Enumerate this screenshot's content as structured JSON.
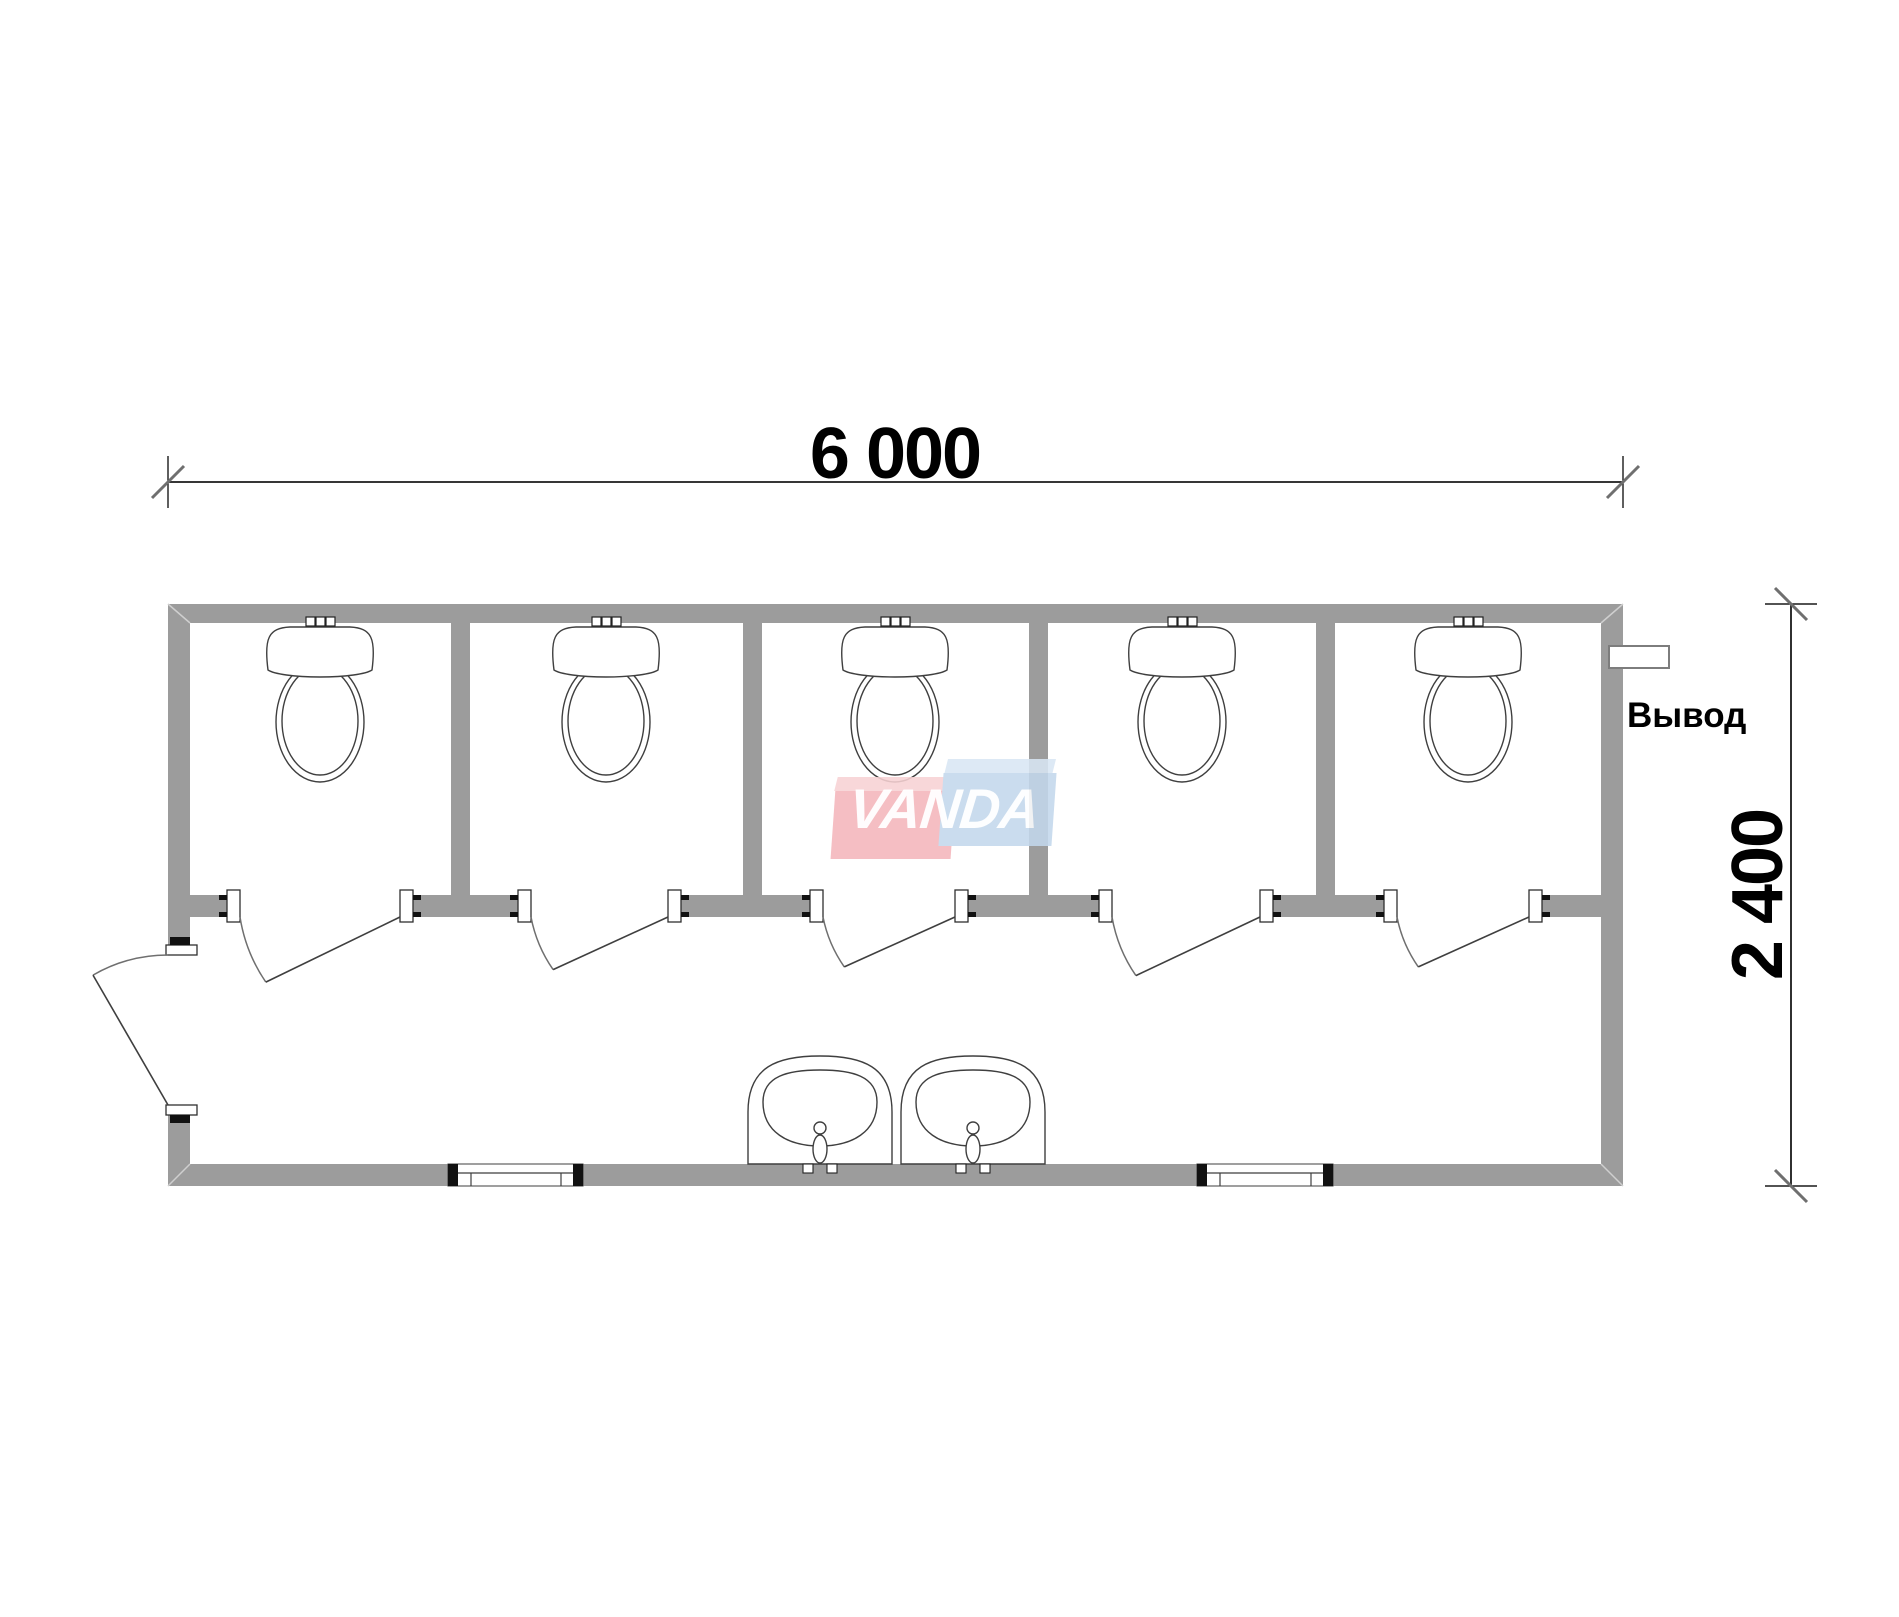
{
  "title": "Sanitary cabin floor plan 6000x2400 with five toilets and two sinks",
  "labels": {
    "width_dimension": "6 000",
    "height_dimension": "2 400",
    "outlet": "Вывод",
    "watermark": "VANDA"
  },
  "colors": {
    "background": "#ffffff",
    "wall_fill": "#9c9c9c",
    "wall_miter": "#cfcfcf",
    "outline": "#3a3a3a",
    "fixture_line": "#3f3f3f",
    "dim_line": "#1a1a1a",
    "tick": "#6f6f6f",
    "jamb_fill": "#ffffff",
    "jamb_stroke": "#2f2f2f",
    "mark_black": "#111111",
    "watermark_pink": "#f4b6bb",
    "watermark_pink_light": "#f8d2d4",
    "watermark_blue": "#c3d8ec",
    "watermark_blue_light": "#d9e7f4",
    "watermark_text": "#ffffff"
  },
  "plan": {
    "building": {
      "left": 168,
      "top": 604,
      "right": 1623,
      "bottom": 1186,
      "top_wall_h": 19,
      "side_wall_w": 22,
      "bottom_wall_h": 22
    },
    "left_door": {
      "opening_top": 955,
      "opening_bottom": 1105,
      "jamb_h": 10,
      "hinge": [
        168,
        1105
      ],
      "radius": 150,
      "open_angle_deg": 30
    },
    "front_wall": {
      "top": 895,
      "h": 22
    },
    "partitions": [
      [
        451,
        470
      ],
      [
        743,
        762
      ],
      [
        1029,
        1048
      ],
      [
        1316,
        1335
      ]
    ],
    "partition_top": 623,
    "stall_openings": [
      [
        240,
        400
      ],
      [
        531,
        668
      ],
      [
        823,
        955
      ],
      [
        1112,
        1260
      ],
      [
        1397,
        1529
      ]
    ],
    "jamb_w": 13,
    "door_open_angle_deg": 33,
    "toilets_cx": [
      320,
      606,
      895,
      1182,
      1468
    ],
    "toilet": {
      "wall_buttons_y": 617,
      "tank_top": 627,
      "tank_bottom": 677,
      "tank_half_w": 52,
      "bowl_cy": 722,
      "bowl_rx": 44,
      "bowl_ry": 60
    },
    "sinks_cx": [
      820,
      973
    ],
    "sink": {
      "half_w": 72,
      "top": 1056,
      "base": 1164
    },
    "windows": [
      [
        448,
        583
      ],
      [
        1197,
        1333
      ]
    ],
    "outlet_rect": {
      "x": 1609,
      "y": 646,
      "w": 60,
      "h": 22
    },
    "dim_top": {
      "y": 482,
      "x1": 168,
      "x2": 1623,
      "ext_y1": 456,
      "ext_y2": 508
    },
    "dim_right": {
      "x": 1791,
      "y1": 604,
      "y2": 1186,
      "ext_x1": 1765,
      "ext_x2": 1817
    }
  },
  "annotations": {
    "dim_top_center_x": 895,
    "dim_top_text_top": 418,
    "dim_right_center_x": 1758,
    "dim_right_center_y": 895,
    "outlet_label_x": 1627,
    "outlet_label_y": 698,
    "watermark_box": {
      "x": 833,
      "y": 757,
      "w": 222,
      "h": 102
    }
  }
}
